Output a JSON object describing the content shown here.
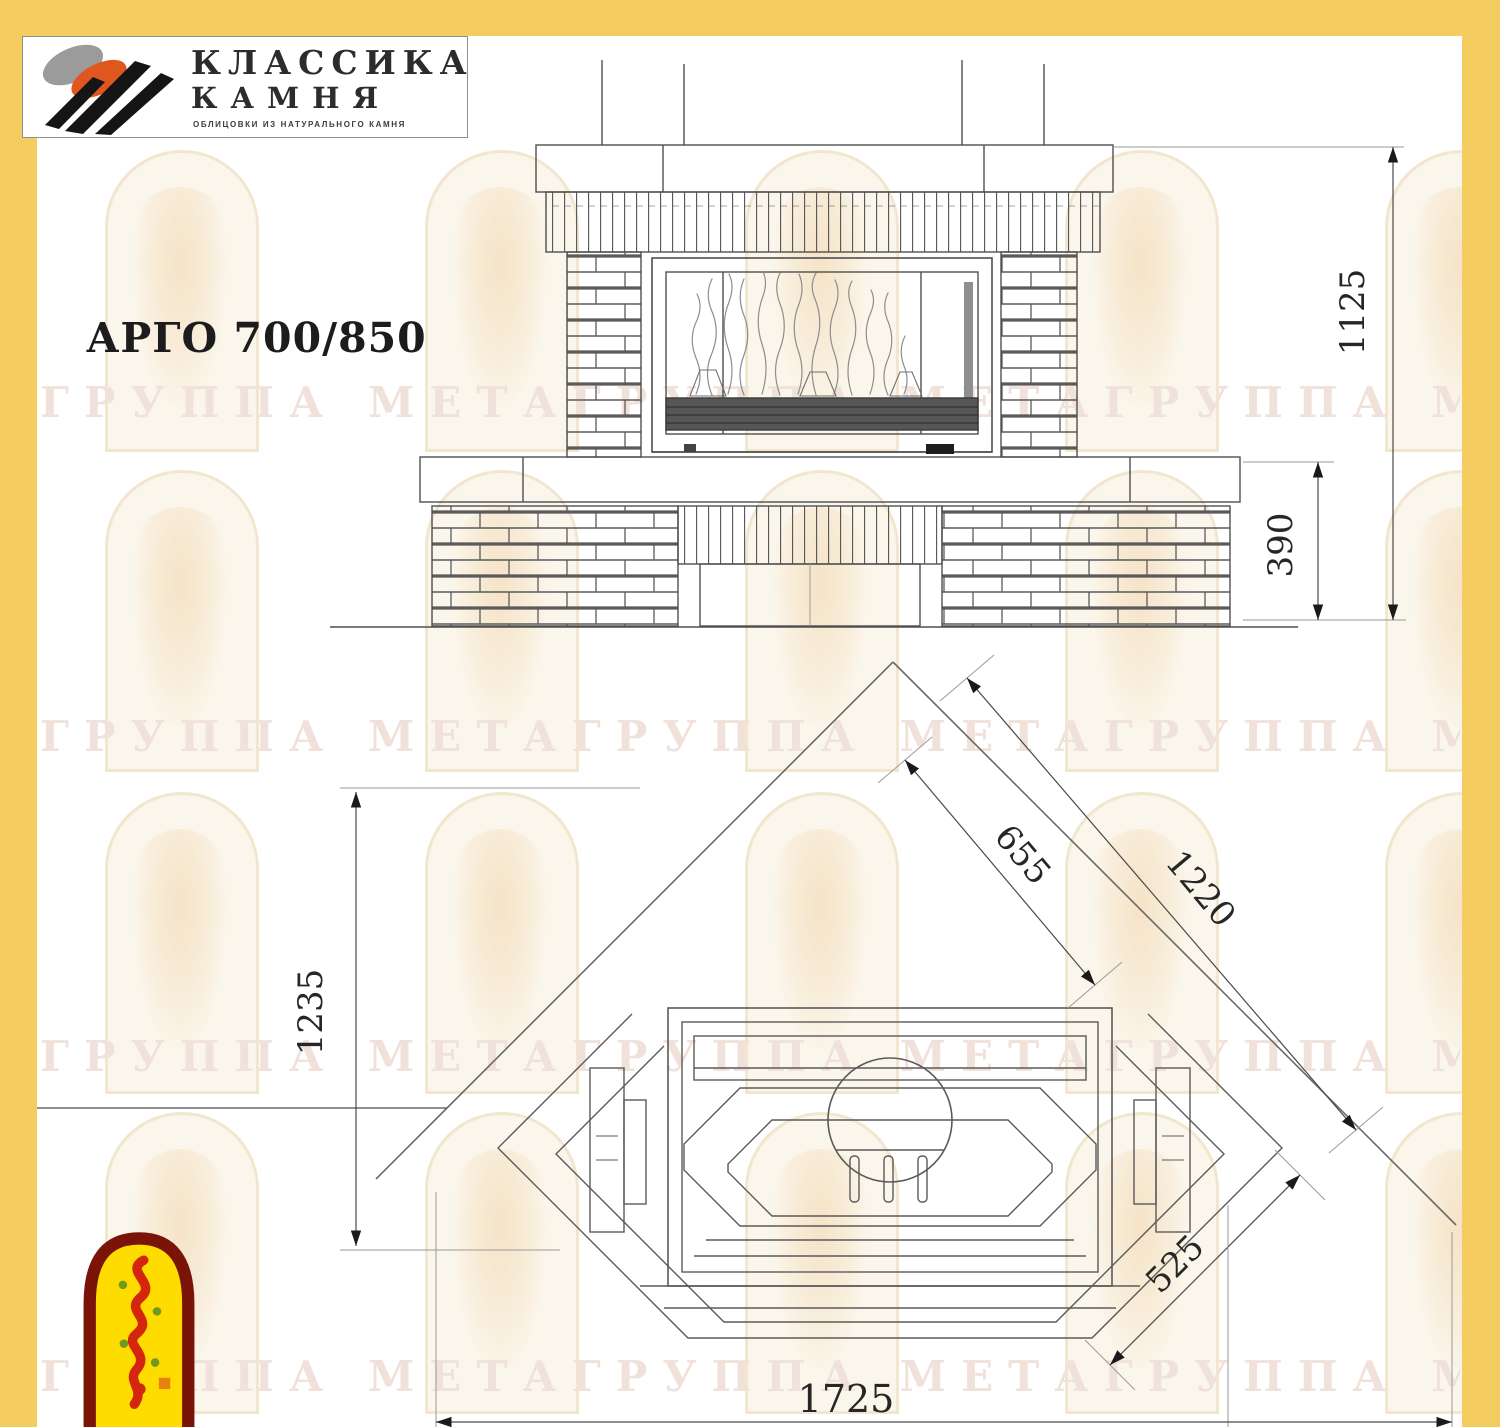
{
  "brand": {
    "line1": "КЛАССИКА",
    "line2": "КАМНЯ",
    "tagline": "ОБЛИЦОВКИ ИЗ НАТУРАЛЬНОГО КАМНЯ"
  },
  "title": "АРГО 700/850",
  "watermark": {
    "text": "ГРУППА МЕТАГРУППА МЕТАГРУППА МЕТА"
  },
  "drawing": {
    "front_view": {
      "dim_total_height": "1125",
      "dim_base_height": "390"
    },
    "plan_view": {
      "dim_firebox_front": "655",
      "dim_wall_diagonal": "1220",
      "dim_depth": "1235",
      "dim_side_chamfer": "525",
      "dim_overall_width": "1725"
    }
  },
  "colors": {
    "frame_yellow": "#F5CC60",
    "line_gray": "#4F4F4F",
    "logo_orange": "#E0561F",
    "logo_gray": "#9B9B9B",
    "logo_black": "#151515",
    "emblem_red": "#D3260C",
    "emblem_dark_red": "#7A1408",
    "emblem_yellow": "#FFDC00",
    "emblem_green": "#6F9A1F"
  }
}
